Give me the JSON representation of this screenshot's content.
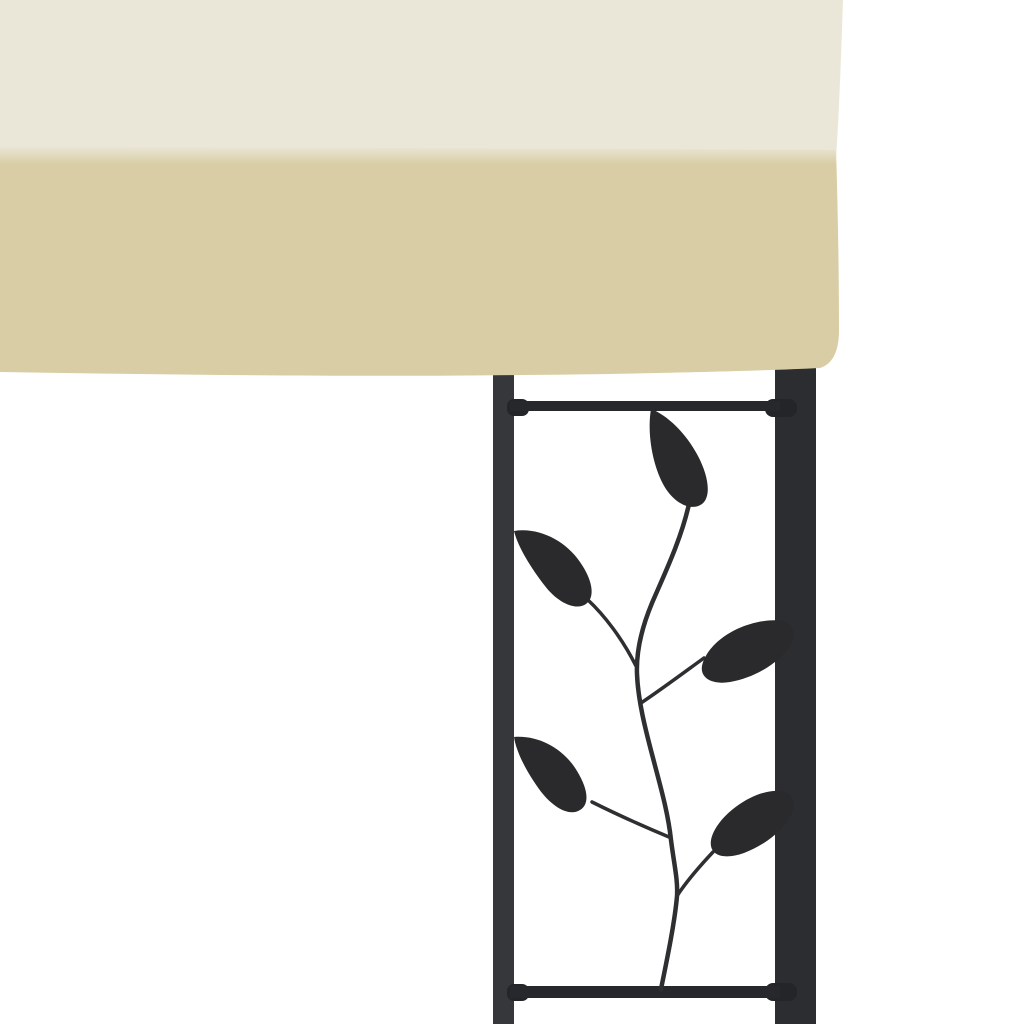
{
  "image": {
    "kind": "product-photo",
    "subject": "Corner detail of a wall gazebo: cream fabric canopy over black steel frame with decorative leaf-scroll ornament panel",
    "background_style": "white studio backdrop",
    "leaf_count": "5"
  },
  "colors": {
    "background": "#ffffff",
    "canopy_top": "#ebe7d8",
    "canopy_valance": "#d8cda4",
    "left_bar": "#35373a",
    "right_post": "#2b2d30",
    "rail": "#27282b",
    "rail_cap": "#242528",
    "leaf": "#2a2a2c",
    "stem": "#2e2f31"
  }
}
